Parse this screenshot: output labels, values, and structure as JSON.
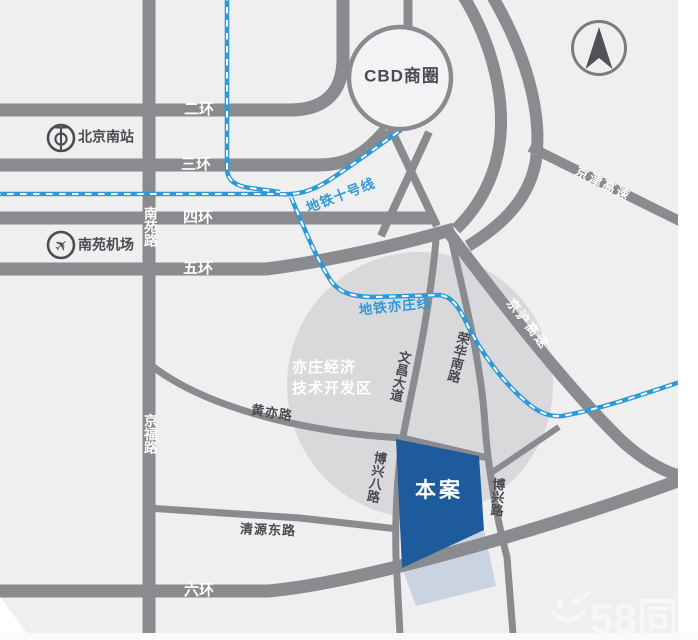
{
  "map_type": "location-schematic-map",
  "colors": {
    "bg": "#f0eff0",
    "disc": "#d9d9db",
    "road": "#8a8b8f",
    "cbdfill": "#f3f2f4",
    "subway": "#2d9ad7",
    "site": "#1e5b9c",
    "dark": "#4a4a50",
    "dark2": "#515156",
    "white": "#ffffff",
    "strip": "#fafafb"
  },
  "watermark": {
    "text": "58同"
  },
  "site": {
    "label": "本案"
  },
  "landmarks": {
    "cbd": "CBD商圈",
    "railway_station": "北京南站",
    "airport": "南苑机场",
    "district_line1": "亦庄经济",
    "district_line2": "技术开发区"
  },
  "ring_roads": [
    "二环",
    "三环",
    "四环",
    "五环",
    "六环"
  ],
  "subway_lines": [
    "地铁十号线",
    "地铁亦庄线"
  ],
  "expressways": [
    "京津高速",
    "京沪高速"
  ],
  "streets": [
    "南苑路",
    "京福路",
    "黄亦路",
    "清源东路",
    "文昌大道",
    "荣华南路",
    "博兴八路",
    "博兴路"
  ],
  "labels": [
    {
      "n": "cbd-area-label",
      "t": "CBD商圈",
      "x": 402,
      "y": 77,
      "s": 17,
      "c": "dark",
      "w": 600,
      "ls": 1
    },
    {
      "n": "ring-road-2-label",
      "t": "二环",
      "x": 199,
      "y": 110,
      "s": 15,
      "c": "white",
      "w": 700
    },
    {
      "n": "ring-road-3-label",
      "t": "三环",
      "x": 196,
      "y": 165,
      "s": 15,
      "c": "white",
      "w": 700
    },
    {
      "n": "ring-road-4-label",
      "t": "四环",
      "x": 198,
      "y": 218,
      "s": 15,
      "c": "white",
      "w": 700
    },
    {
      "n": "ring-road-5-label",
      "t": "五环",
      "x": 198,
      "y": 269,
      "s": 15,
      "c": "white",
      "w": 700
    },
    {
      "n": "ring-road-6-label",
      "t": "六环",
      "x": 199,
      "y": 591,
      "s": 15,
      "c": "white",
      "w": 700
    },
    {
      "n": "nanyuan-rd-label",
      "t": "南苑路",
      "x": 149,
      "y": 227,
      "s": 13.5,
      "c": "white",
      "w": 700,
      "v": 1
    },
    {
      "n": "jingfu-rd-label",
      "t": "京福路",
      "x": 149,
      "y": 434,
      "s": 13.5,
      "c": "white",
      "w": 700,
      "v": 1
    },
    {
      "n": "beijing-south-label",
      "t": "北京南站",
      "x": 78,
      "y": 137,
      "s": 14,
      "c": "dark",
      "w": 600,
      "a": "l"
    },
    {
      "n": "nanyuan-airport-label",
      "t": "南苑机场",
      "x": 78,
      "y": 245,
      "s": 14,
      "c": "dark",
      "w": 600,
      "a": "l"
    },
    {
      "n": "subway-line10-label",
      "t": "地铁十号线",
      "x": 341,
      "y": 196,
      "s": 13.5,
      "c": "subway",
      "w": 700,
      "r": -21,
      "ls": 1
    },
    {
      "n": "subway-yizhuang-label",
      "t": "地铁亦庄线",
      "x": 395,
      "y": 307,
      "s": 13.5,
      "c": "subway",
      "w": 700,
      "r": -6,
      "ls": 1
    },
    {
      "n": "jingjin-expwy-label",
      "t": "京津高速",
      "x": 603,
      "y": 184,
      "s": 13,
      "c": "white",
      "w": 700,
      "r": 27,
      "ls": 2
    },
    {
      "n": "jinghu-expwy-label",
      "t": "京沪高速",
      "x": 528,
      "y": 324,
      "s": 13,
      "c": "white",
      "w": 700,
      "r": 52,
      "ls": 2
    },
    {
      "n": "huangyi-rd-label",
      "t": "黄亦路",
      "x": 272,
      "y": 413,
      "s": 13,
      "c": "dark",
      "w": 600,
      "r": 9,
      "ls": 1
    },
    {
      "n": "qingyuan-east-rd-label",
      "t": "清源东路",
      "x": 268,
      "y": 530,
      "s": 13,
      "c": "dark",
      "w": 600,
      "r": 2,
      "ls": 1
    },
    {
      "n": "wenchang-ave-label",
      "t": "文昌大道",
      "x": 400,
      "y": 376,
      "s": 13,
      "c": "dark",
      "w": 600,
      "r": 12,
      "v": 1
    },
    {
      "n": "ronghua-south-rd-label",
      "t": "荣华南路",
      "x": 458,
      "y": 357,
      "s": 13,
      "c": "dark",
      "w": 600,
      "r": 14,
      "v": 1
    },
    {
      "n": "boxing-8th-rd-label",
      "t": "博兴八路",
      "x": 376,
      "y": 477,
      "s": 13,
      "c": "dark",
      "w": 600,
      "r": 10,
      "v": 1
    },
    {
      "n": "boxing-rd-label",
      "t": "博兴路",
      "x": 497,
      "y": 497,
      "s": 13,
      "c": "dark",
      "w": 600,
      "r": 4,
      "v": 1
    },
    {
      "n": "district-label-line1",
      "t": "亦庄经济",
      "x": 292,
      "y": 368,
      "s": 15,
      "c": "white",
      "w": 700,
      "a": "l",
      "ls": 1
    },
    {
      "n": "district-label-line2",
      "t": "技术开发区",
      "x": 292,
      "y": 389,
      "s": 15,
      "c": "white",
      "w": 700,
      "a": "l",
      "ls": 1
    },
    {
      "n": "site-label",
      "t": "本案",
      "x": 439,
      "y": 491,
      "s": 21,
      "c": "white",
      "w": 700,
      "ls": 3
    }
  ]
}
